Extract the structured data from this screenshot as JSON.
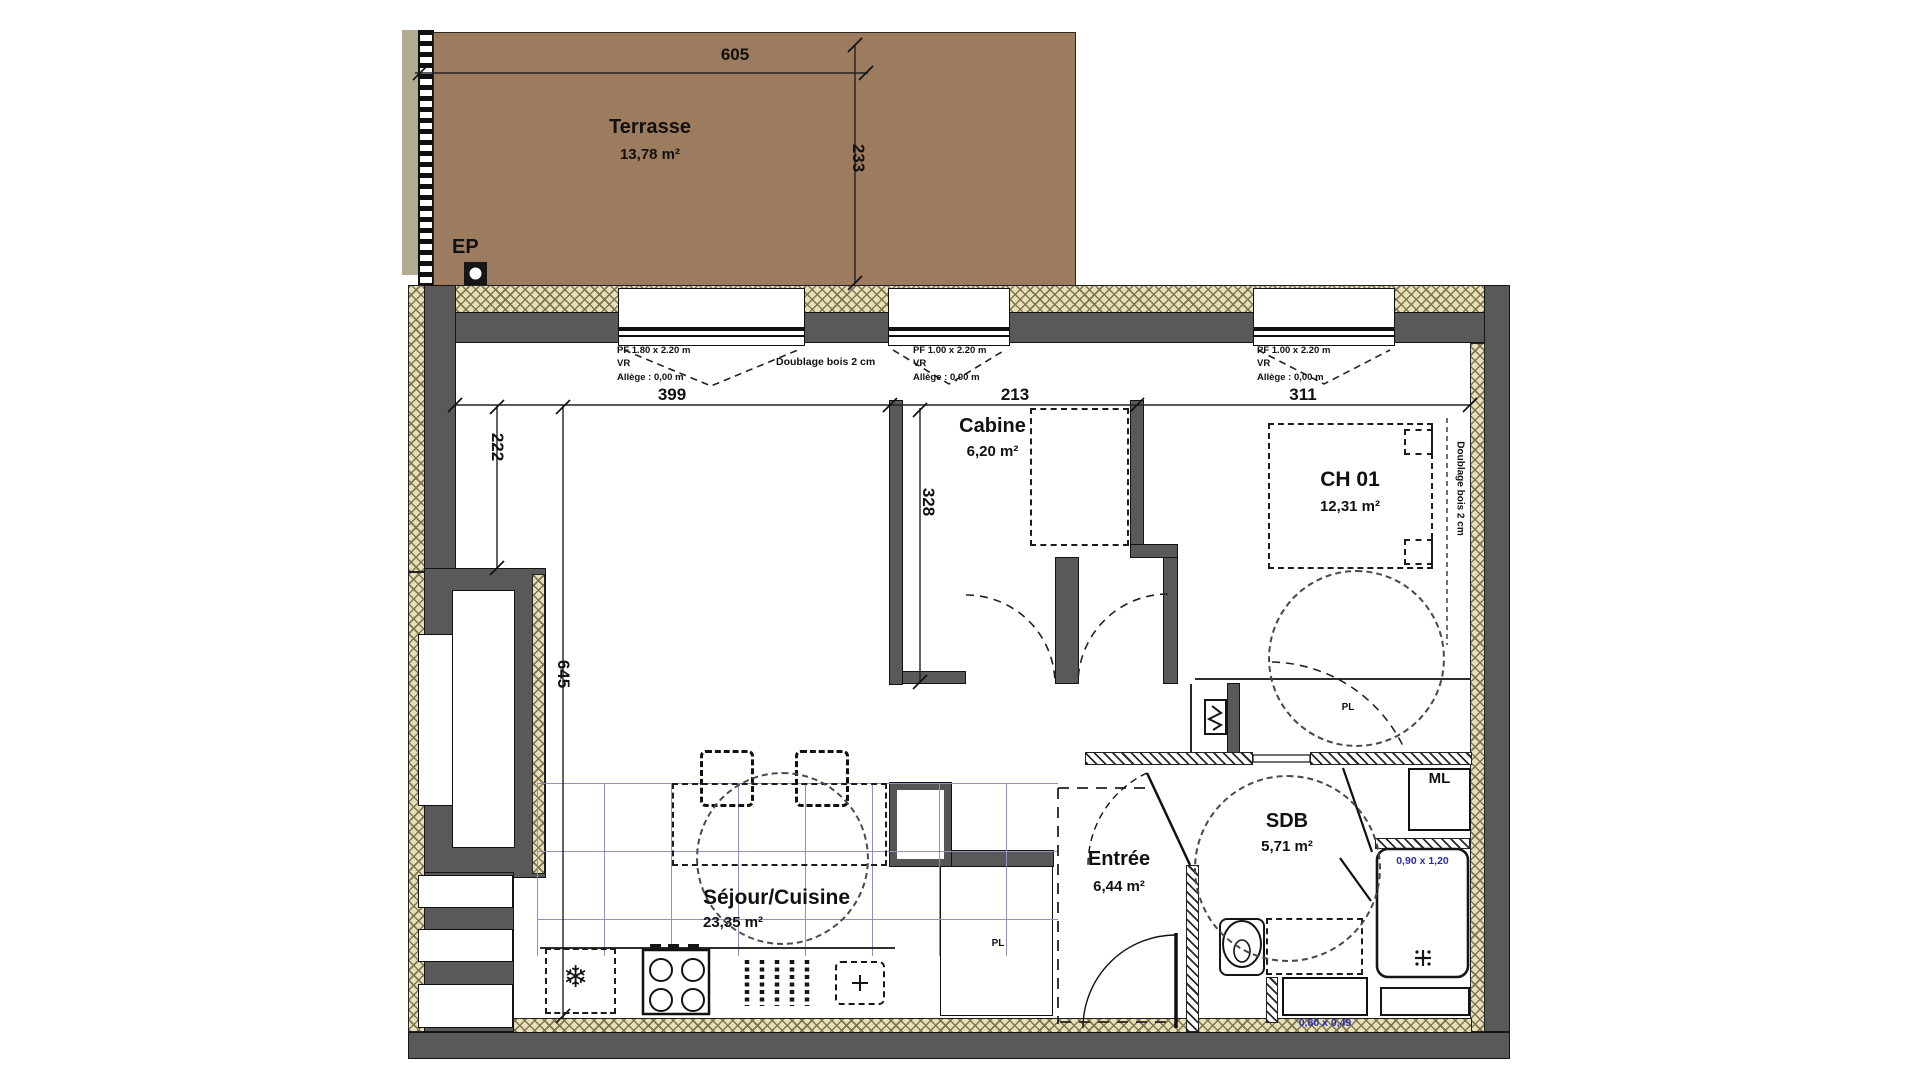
{
  "colors": {
    "terrace": "#9c7b5f",
    "wall_gray": "#595959",
    "hatch_bg": "#e6dfb8",
    "tile_line": "#8d92c0",
    "dim_blue": "#2b2bb0"
  },
  "terrace": {
    "name": "Terrasse",
    "area": "13,78 m²",
    "width_dim": "605",
    "height_dim": "233",
    "drain_label": "EP"
  },
  "windows": {
    "w1": {
      "size": "PF 1.80 x 2.20 m",
      "shutter": "VR",
      "sill": "Allège : 0,00 m"
    },
    "w2": {
      "size": "PF 1.00 x 2.20 m",
      "shutter": "VR",
      "sill": "Allège : 0,00 m"
    },
    "w3": {
      "size": "PF 1.00 x 2.20 m",
      "shutter": "VR",
      "sill": "Allège : 0,00 m"
    }
  },
  "annotations": {
    "doublage_top": "Doublage bois 2 cm",
    "doublage_right": "Doublage bois 2 cm"
  },
  "dimensions": {
    "sejour_width": "399",
    "cabine_width": "213",
    "ch01_width": "311",
    "left_upper": "222",
    "cabine_depth": "328",
    "interior_height": "645"
  },
  "rooms": {
    "cabine": {
      "name": "Cabine",
      "area": "6,20 m²"
    },
    "ch01": {
      "name": "CH 01",
      "area": "12,31 m²"
    },
    "sejour": {
      "name": "Séjour/Cuisine",
      "area": "23,35 m²"
    },
    "entree": {
      "name": "Entrée",
      "area": "6,44 m²"
    },
    "sdb": {
      "name": "SDB",
      "area": "5,71 m²"
    }
  },
  "fixtures": {
    "closet_ch01": "PL",
    "closet_hall": "PL",
    "washing_machine": "ML",
    "shower_size": "0,90 x 1,20",
    "vanity_size": "0,80 x 0,49",
    "fridge_icon": "❄"
  }
}
